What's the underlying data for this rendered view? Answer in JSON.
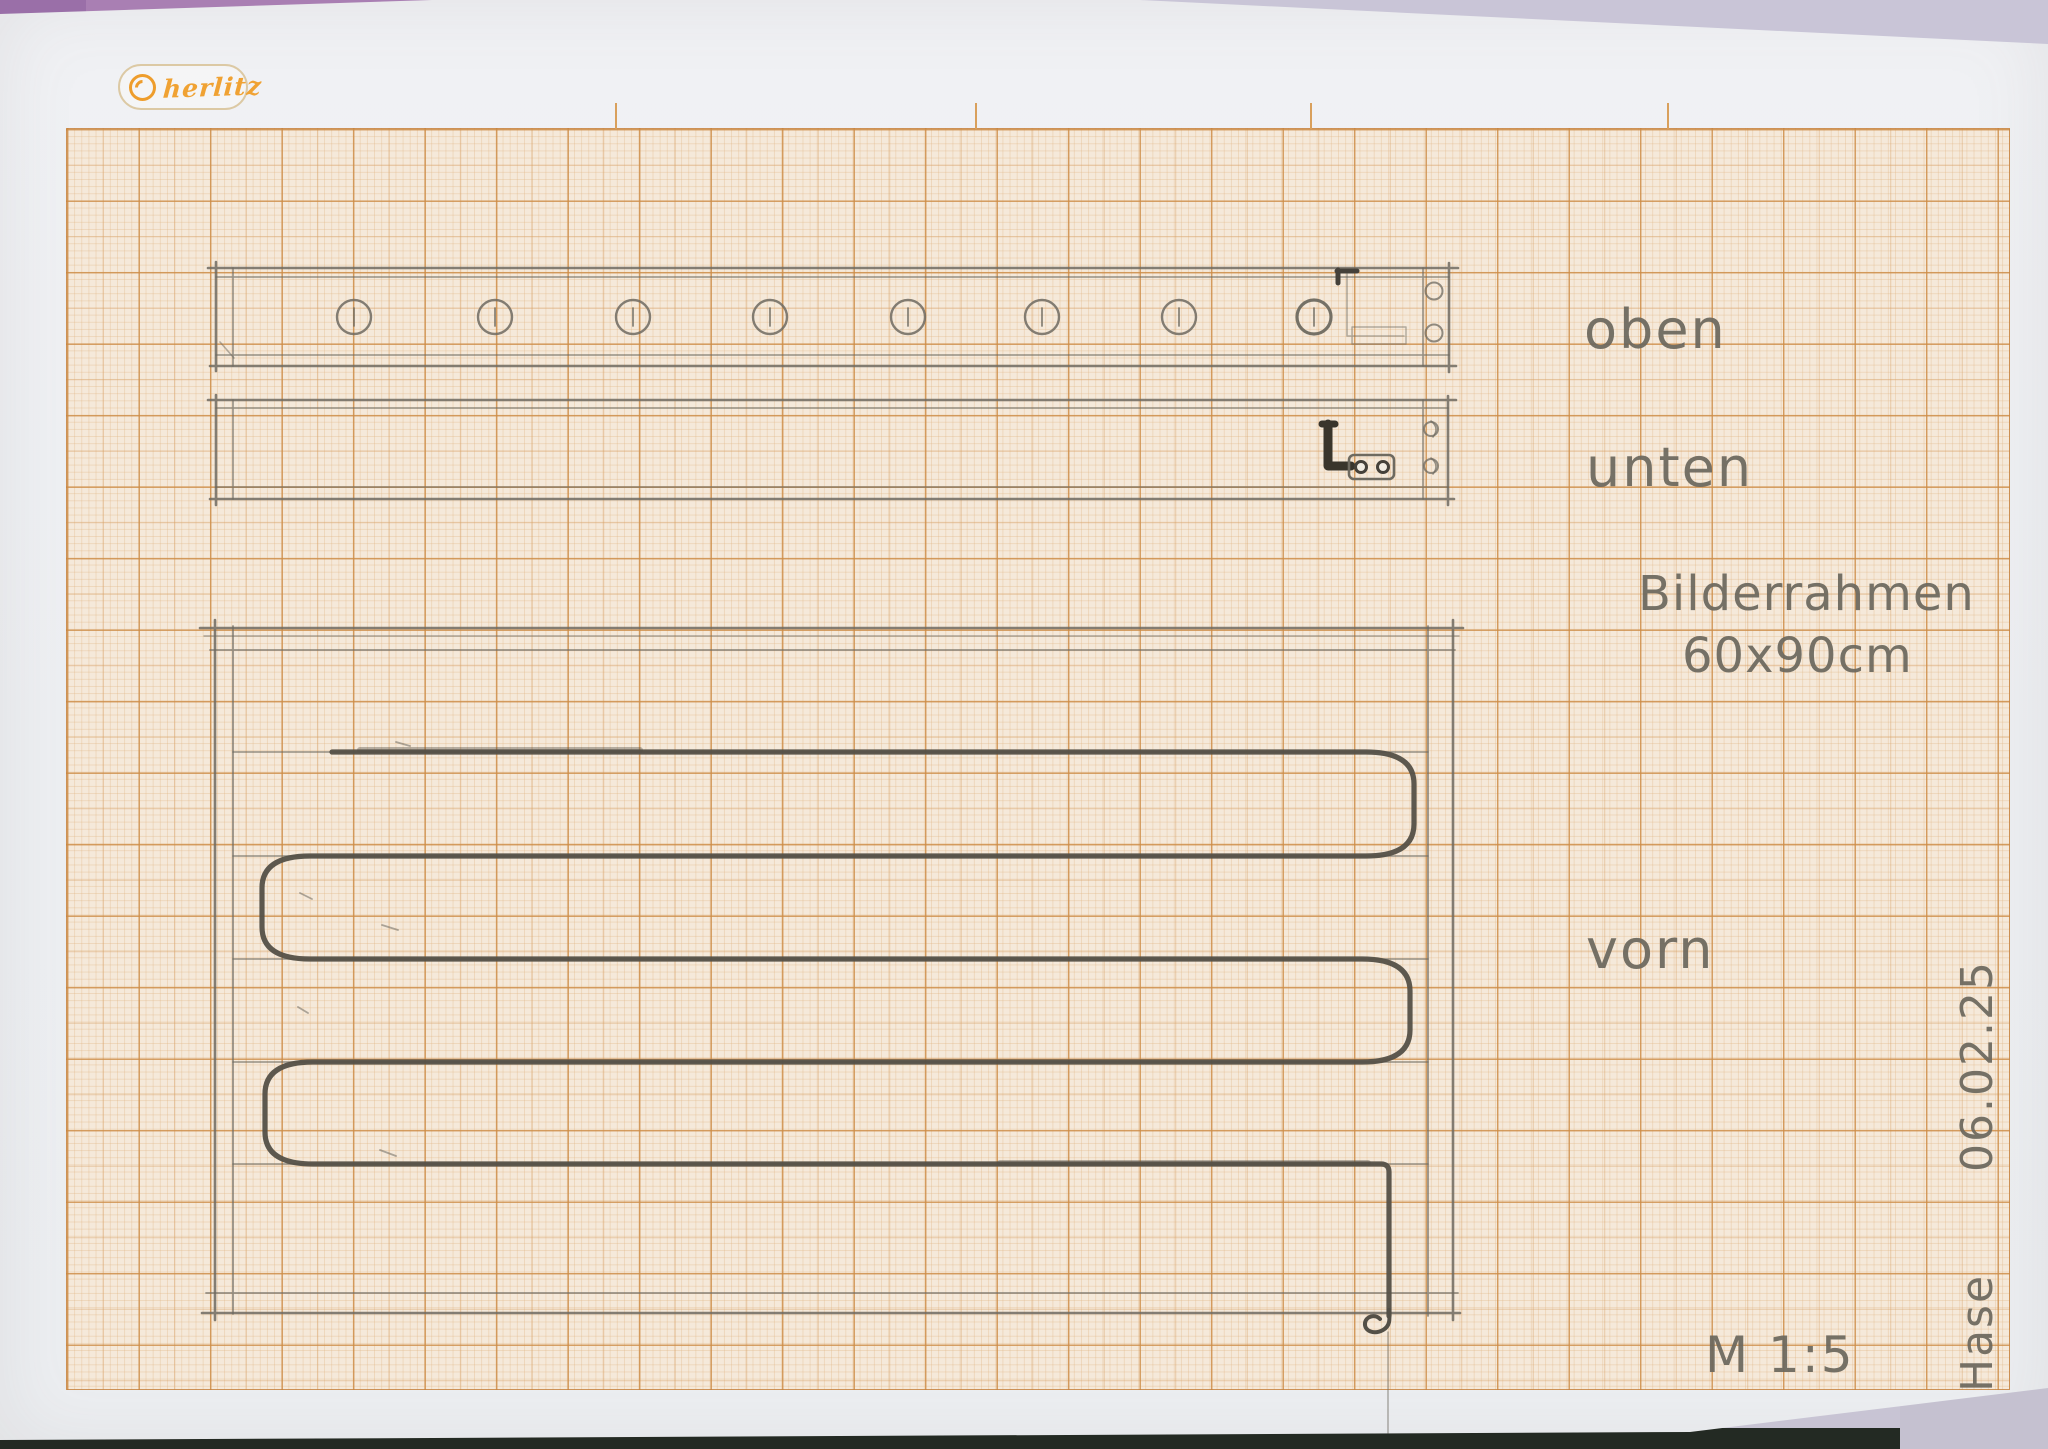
{
  "page": {
    "kind": "hand-drawn technical sketch on millimeter graph paper"
  },
  "logo": {
    "text": "herlitz"
  },
  "labels": {
    "top_view": "oben",
    "bottom_view": "unten",
    "front_view": "vorn",
    "title_line1": "Bilderrahmen",
    "title_line2": "60x90cm",
    "scale": "M 1:5",
    "author": "Hase",
    "date": "06.02.25"
  },
  "views": {
    "oben": {
      "label": "oben",
      "hole_count": 8
    },
    "unten": {
      "label": "unten"
    },
    "vorn": {
      "label": "vorn",
      "serpentine_rows": 5
    }
  },
  "colors": {
    "grid_major": "#cd8c46",
    "grid_minor": "#e0b482",
    "grid_paper": "#f5e9da",
    "pencil": "#6e6a60",
    "pencil_dark": "#45413a",
    "logo_orange": "#f0a233",
    "background_lavender": "#c8c4d4",
    "background_purple": "#a97fb3",
    "background_maroon": "#6e1d2b",
    "background_dark_strip": "#232a23"
  }
}
